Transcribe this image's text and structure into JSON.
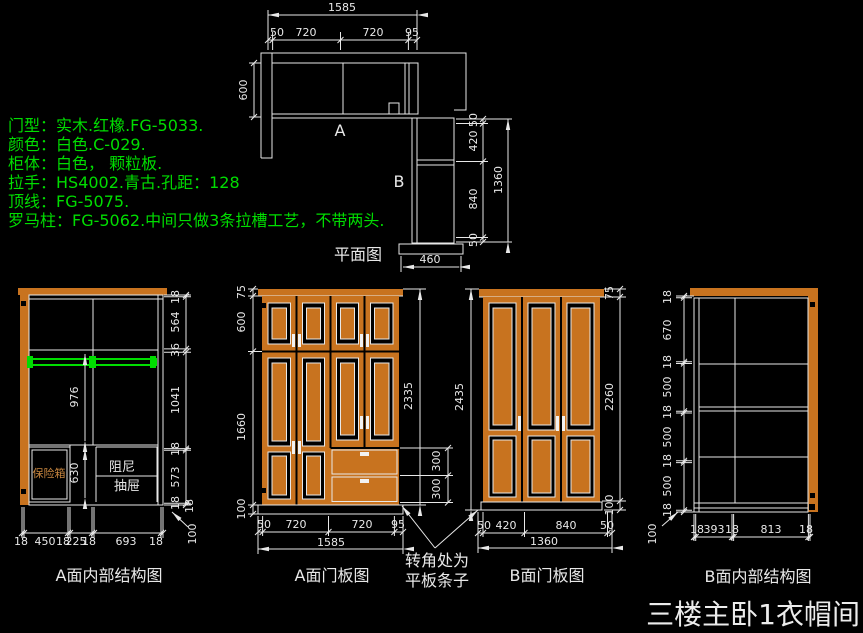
{
  "title": "三楼主卧1衣帽间",
  "notes": {
    "lines": [
      "门型：实木.红橡.FG-5033.",
      "颜色：白色.C-029.",
      "柜体：白色， 颗粒板.",
      "拉手：HS4002.青古.孔距：128",
      "顶线：FG-5075.",
      "罗马柱：FG-5062.中间只做3条拉槽工艺，不带两头."
    ]
  },
  "plan": {
    "label": "平面图",
    "section_a": "A",
    "section_b": "B",
    "dims": {
      "overall_width": "1585",
      "top_chain": [
        "50",
        "720",
        "720",
        "95"
      ],
      "depth_left": "600",
      "right_chain": [
        "50",
        "420",
        "840",
        "50"
      ],
      "right_overall": "1360",
      "bottom_width": "460"
    }
  },
  "views": {
    "a_internal": {
      "label": "A面内部结构图",
      "right_chain": [
        "18",
        "564",
        "36",
        "1041",
        "18",
        "573",
        "18"
      ],
      "hang_height": "976",
      "safe_column_height": "630",
      "safe_label": "保险箱",
      "drawer_label_line1": "阻尼",
      "drawer_label_line2": "抽屉",
      "bottom_chain": [
        "18",
        "450",
        "18",
        "225",
        "18",
        "693",
        "18"
      ],
      "base_panel": "18",
      "base_height": "100"
    },
    "a_doors": {
      "label": "A面门板图",
      "left_chain": [
        "75",
        "600",
        "1660",
        "100"
      ],
      "right_overall": "2335",
      "drawer_dims": [
        "300",
        "300"
      ],
      "bottom_chain": [
        "50",
        "720",
        "720",
        "95"
      ],
      "bottom_overall": "1585"
    },
    "b_doors": {
      "label": "B面门板图",
      "left_overall": "2435",
      "right_chain": [
        "75",
        "2260",
        "100"
      ],
      "bottom_chain": [
        "50",
        "420",
        "840",
        "50"
      ],
      "bottom_overall": "1360"
    },
    "b_internal": {
      "label": "B面内部结构图",
      "left_chain": [
        "18",
        "670",
        "18",
        "500",
        "18",
        "500",
        "18",
        "500",
        "18"
      ],
      "bottom_chain": [
        "18",
        "393",
        "18",
        "813",
        "18"
      ],
      "base_height": "100"
    }
  },
  "corner_note": {
    "line1": "转角处为",
    "line2": "平板条子"
  },
  "colors": {
    "background": "#000000",
    "line": "#e8e8e8",
    "wood": "#c8731f",
    "accent_green": "#00dd00",
    "safe_text": "#c8863f"
  }
}
